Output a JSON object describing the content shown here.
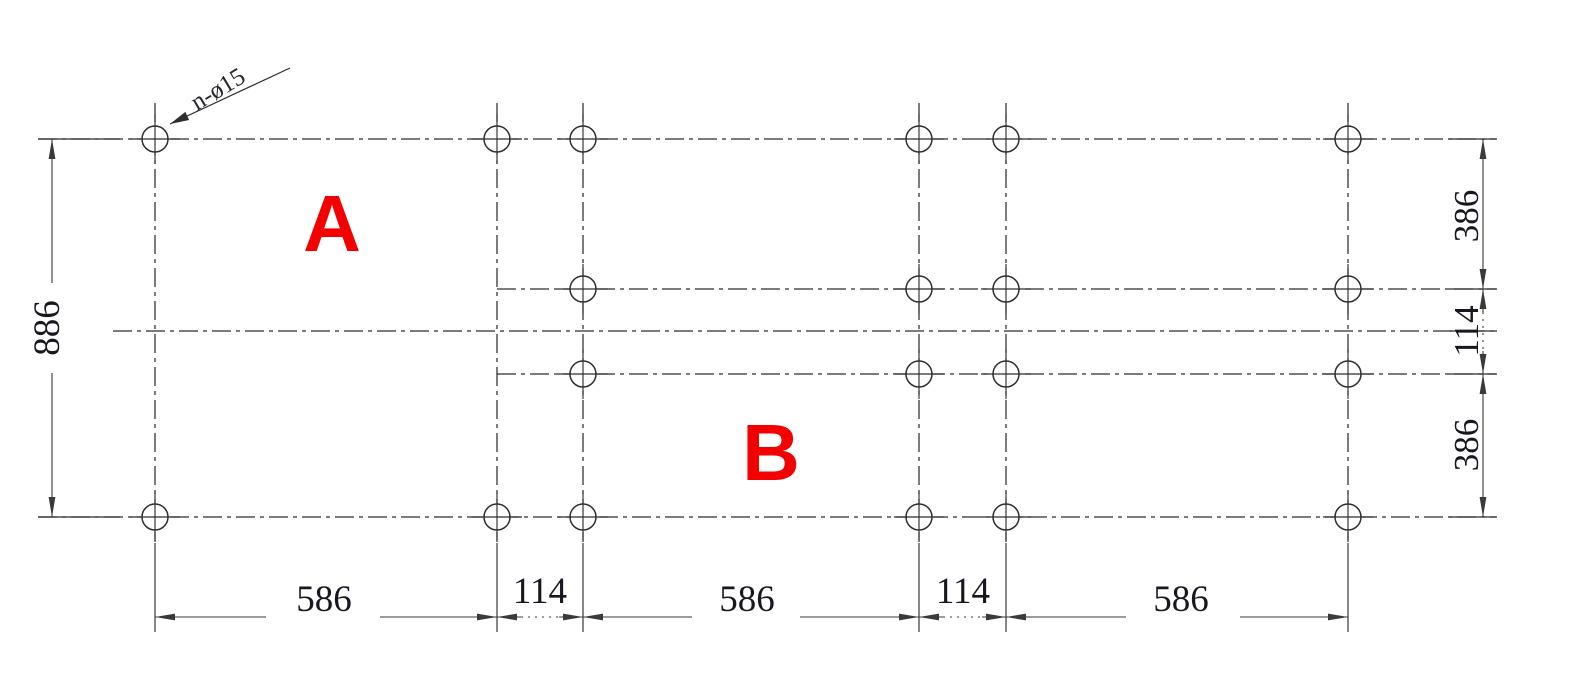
{
  "drawing": {
    "title": "hole-pattern-layout",
    "canvas": {
      "width": 1588,
      "height": 696,
      "background": "#ffffff"
    },
    "colors": {
      "line": "#2e2e2e",
      "dim_line": "#3a3a3a",
      "text": "#17171f",
      "red": "#f40000"
    },
    "hole_radius": 13,
    "columns": [
      155,
      497,
      583,
      919,
      1006,
      1348
    ],
    "rows": [
      139,
      289,
      374,
      517
    ],
    "center_row_y": 331,
    "full_rows": [
      139,
      517
    ],
    "inner_rows": [
      289,
      374
    ],
    "inner_row_columns": [
      583,
      919,
      1006,
      1348
    ],
    "centerlines_h": [
      {
        "y": 139,
        "x1": 38,
        "x2": 1496
      },
      {
        "y": 289,
        "x1": 497,
        "x2": 1496
      },
      {
        "y": 331,
        "x1": 113,
        "x2": 1496
      },
      {
        "y": 374,
        "x1": 497,
        "x2": 1496
      },
      {
        "y": 517,
        "x1": 38,
        "x2": 1496
      }
    ],
    "centerlines_v_y1": 103,
    "centerlines_v_y2": 541,
    "callout": {
      "text": "n-ø15",
      "text_x": 222,
      "text_y": 96,
      "angle": -31,
      "font_size": 25,
      "leader": {
        "x1": 290,
        "y1": 68,
        "x2": 170,
        "y2": 124
      }
    },
    "region_labels": [
      {
        "text": "A",
        "x": 332,
        "y": 251,
        "font_size": 80
      },
      {
        "text": "B",
        "x": 771,
        "y": 480,
        "font_size": 80
      }
    ],
    "dim_left": {
      "value": "886",
      "line_x": 52,
      "y1": 139,
      "y2": 517,
      "label_x": 59,
      "label_y": 328,
      "gap1": 283,
      "gap2": 373,
      "ext_x1": 38,
      "ext_x2": 120,
      "font_size": 37
    },
    "dim_right": {
      "line_x": 1483,
      "label_x": 1478,
      "ext_x1": 1449,
      "ext_x2": 1497,
      "tick_ys": [
        139,
        289,
        331,
        374,
        517
      ],
      "font_size": 35,
      "segments": [
        {
          "value": "386",
          "y1": 139,
          "y2": 289,
          "label_y": 216,
          "style": "plain"
        },
        {
          "value": "114",
          "y1": 289,
          "y2": 374,
          "label_y": 331,
          "style": "dotted_mid"
        },
        {
          "value": "386",
          "y1": 374,
          "y2": 517,
          "label_y": 445,
          "style": "plain"
        }
      ]
    },
    "dim_bottom": {
      "line_y": 617,
      "ext_y1": 543,
      "ext_y2": 632,
      "font_size": 37,
      "segments": [
        {
          "value": "586",
          "x1": 155,
          "x2": 497,
          "label_x": 324,
          "label_y": 611,
          "style": "gap",
          "gap1": 266,
          "gap2": 380
        },
        {
          "value": "114",
          "x1": 497,
          "x2": 583,
          "label_x": 540,
          "label_y": 603,
          "style": "dotted_mid"
        },
        {
          "value": "586",
          "x1": 583,
          "x2": 919,
          "label_x": 747,
          "label_y": 611,
          "style": "gap",
          "gap1": 692,
          "gap2": 800
        },
        {
          "value": "114",
          "x1": 919,
          "x2": 1006,
          "label_x": 963,
          "label_y": 603,
          "style": "dotted_mid"
        },
        {
          "value": "586",
          "x1": 1006,
          "x2": 1348,
          "label_x": 1181,
          "label_y": 611,
          "style": "gap",
          "gap1": 1126,
          "gap2": 1240
        }
      ]
    }
  }
}
